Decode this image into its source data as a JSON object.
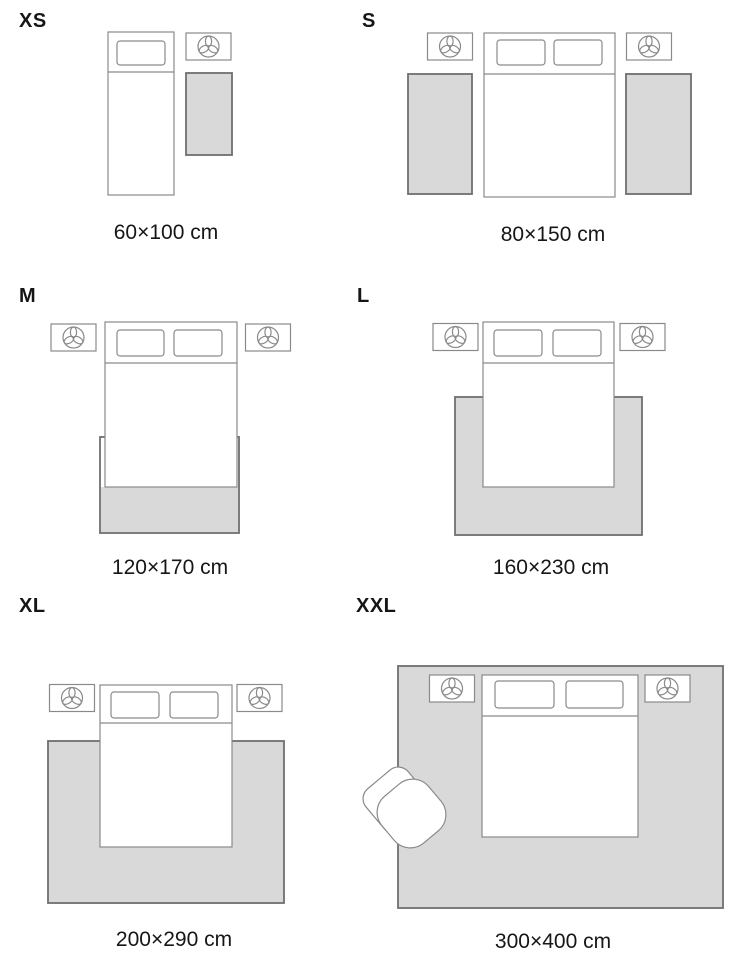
{
  "colors": {
    "rug_fill": "#d9d9d9",
    "rug_border": "#6f6f6f",
    "outline": "#8a8a8a",
    "text": "#161616",
    "background": "#ffffff"
  },
  "icons": {
    "lamp_icon": "trefoil-propeller-in-circle"
  },
  "panels": [
    {
      "id": "xs",
      "size_label": "XS",
      "dimensions": "60×100 cm"
    },
    {
      "id": "s",
      "size_label": "S",
      "dimensions": "80×150 cm"
    },
    {
      "id": "m",
      "size_label": "M",
      "dimensions": "120×170 cm"
    },
    {
      "id": "l",
      "size_label": "L",
      "dimensions": "160×230 cm"
    },
    {
      "id": "xl",
      "size_label": "XL",
      "dimensions": "200×290 cm"
    },
    {
      "id": "xxl",
      "size_label": "XXL",
      "dimensions": "300×400 cm"
    }
  ]
}
